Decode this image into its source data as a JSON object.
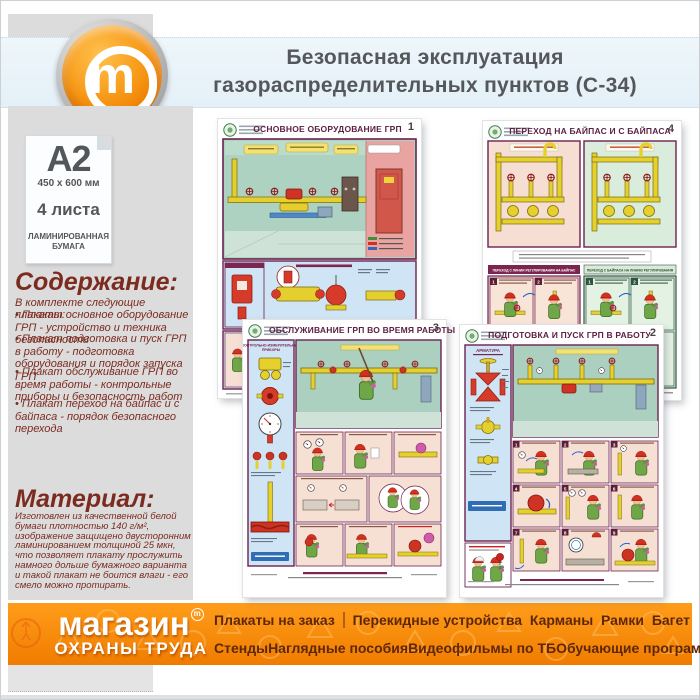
{
  "header": {
    "title_line1": "Безопасная эксплуатация",
    "title_line2": "газораспределительных пунктов (С-34)",
    "logo_letter": "m"
  },
  "sidebar": {
    "format": "А2",
    "size": "450 x 600 мм",
    "sheets": "4 листа",
    "paper_line1": "ЛАМИНИРОВАННАЯ",
    "paper_line2": "БУМАГА",
    "contents_title": "Содержание:",
    "contents_intro": "В комплекте следующие плакаты:",
    "contents_items": [
      "Плакат основное оборудование ГРП - устройство и техника безопасности",
      "Плакат подготовка и пуск ГРП в работу - подготовка оборудования и порядок запуска ГРП",
      "Плакат обслуживание ГРП во время работы - контрольные приборы и безопасность работ",
      "Плакат переход на байпас и с байпаса - порядок безопасного перехода"
    ],
    "material_title": "Материал:",
    "material_text": "Изготовлен из качественной белой бумаги плотностью 140 г/м², изображение защищено двусторонним ламинированием толщиной 25 мкн, что позволяет плакату прослужить намного дольше бумажного варианта и такой плакат не боится влаги - его смело можно протирать."
  },
  "posters": {
    "top_left": {
      "number": "1",
      "title": "ОСНОВНОЕ ОБОРУДОВАНИЕ ГРП"
    },
    "top_right": {
      "number": "4",
      "title": "ПЕРЕХОД НА БАЙПАС И С БАЙПАСА",
      "section_left": "ПЕРЕХОД С ЛИНИИ РЕГУЛИРОВАНИЯ НА БАЙПАС",
      "section_right": "ПЕРЕХОД С БАЙПАСА НА ЛИНИЮ РЕГУЛИРОВАНИЯ",
      "steps": [
        "1",
        "2",
        "3"
      ]
    },
    "bottom_left": {
      "number": "3",
      "title": "ОБСЛУЖИВАНИЕ ГРП ВО ВРЕМЯ РАБОТЫ",
      "column_title_line1": "КОНТРОЛЬНО-ИЗМЕРИТЕЛЬНЫЕ",
      "column_title_line2": "ПРИБОРЫ"
    },
    "bottom_right": {
      "number": "2",
      "title": "ПОДГОТОВКА И ПУСК ГРП В РАБОТУ",
      "column_title": "АРМАТУРА",
      "steps": [
        "1",
        "2",
        "3",
        "4",
        "5",
        "6",
        "7",
        "8",
        "9"
      ]
    }
  },
  "footer": {
    "brand_line1": "магазин",
    "brand_line2": "ОХРАНЫ ТРУДА",
    "brand_mark": "m",
    "menu_row1": [
      "Плакаты на заказ",
      "Перекидные устройства",
      "Карманы",
      "Рамки",
      "Багет"
    ],
    "menu_row2": [
      "Стенды",
      "Наглядные пособия",
      "Видеофильмы по ТБ",
      "Обучающие программы"
    ]
  },
  "colors": {
    "brand_orange": "#f58220",
    "header_blue": "#e9f3f9",
    "sidebar_gray": "#dcdcdc",
    "heading_red": "#7c2b20",
    "poster_maroon": "#6b2150",
    "footer_text_brown": "#5e2708"
  }
}
